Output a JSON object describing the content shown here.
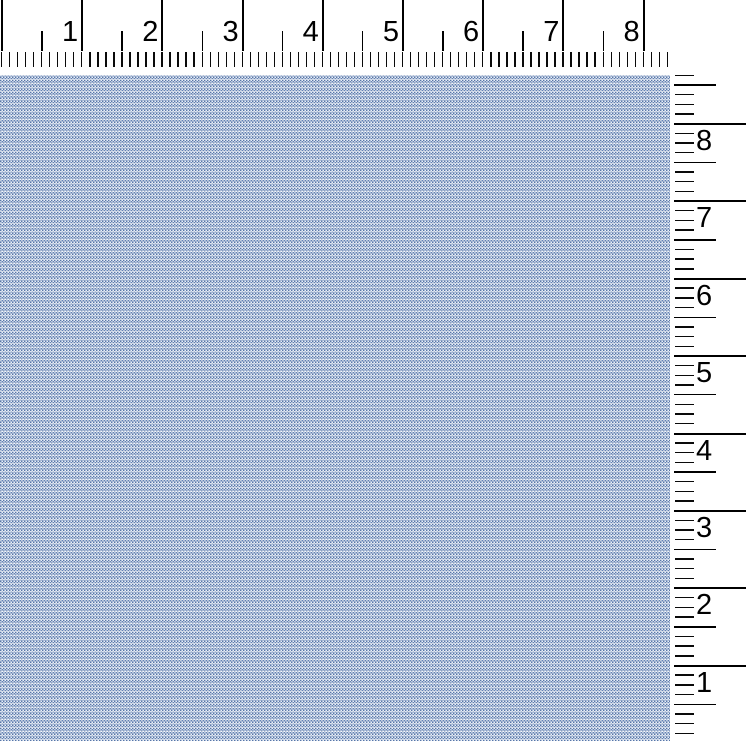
{
  "view": {
    "description": "Fabric swatch shown with an inch ruler along the top edge and an inch ruler along the right edge"
  },
  "horizontal_ruler": {
    "labels": [
      "1",
      "2",
      "3",
      "4",
      "5",
      "6",
      "7",
      "8"
    ],
    "layout": {
      "origin_px": 1,
      "px_per_unit": 80.2,
      "minor_divisions": 10,
      "minor_tick_count": 84,
      "label_gap_px": 3
    }
  },
  "vertical_ruler": {
    "labels": [
      "8",
      "7",
      "6",
      "5",
      "4",
      "3",
      "2",
      "1"
    ],
    "layout": {
      "first_line_y_px": 123,
      "px_per_unit": 77.4,
      "minor_divisions": 8,
      "minor_start_offset": 5,
      "bottom_extent_px": 740,
      "half_tick_count": 9
    }
  },
  "fabric": {
    "average_color": "#b0c4de",
    "thread_color": "#6282b4",
    "base_color": "#edf1f8"
  }
}
